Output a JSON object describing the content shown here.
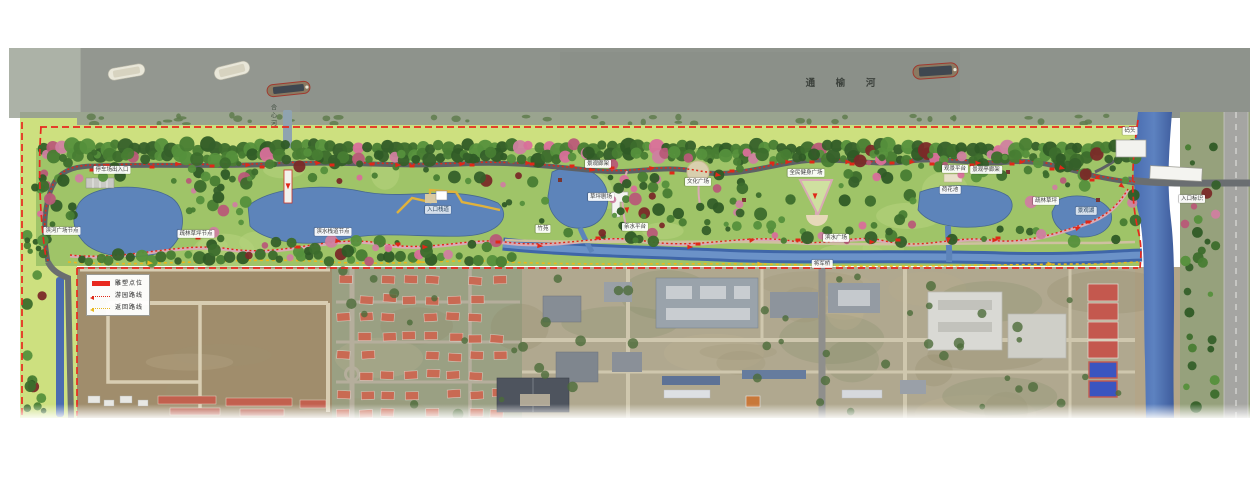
{
  "map": {
    "river_label": "通 榆 河",
    "legend": {
      "items": [
        {
          "symbol": "sculpture-marker",
          "label": "雕塑点位"
        },
        {
          "symbol": "tour-route",
          "label": "游园路线"
        },
        {
          "symbol": "return-route",
          "label": "返回路线"
        }
      ]
    },
    "colors": {
      "boundary": "#e8281e",
      "tour_route": "#e02818",
      "return_route": "#e8b820",
      "park_water": "#5d84ba",
      "big_river": "#8e938c",
      "canal": "#3f66a8"
    },
    "labels": [
      {
        "text": "停车场出入口",
        "x": 112,
        "y": 170
      },
      {
        "text": "滨河广场节点",
        "x": 62,
        "y": 231
      },
      {
        "text": "疏林草坪节点",
        "x": 196,
        "y": 234
      },
      {
        "text": "滨水栈道节点",
        "x": 333,
        "y": 232
      },
      {
        "text": "入口栈道",
        "x": 438,
        "y": 210,
        "variant": "dark"
      },
      {
        "text": "竹苑",
        "x": 543,
        "y": 229
      },
      {
        "text": "景观廊架",
        "x": 598,
        "y": 164
      },
      {
        "text": "草坪剧场",
        "x": 601,
        "y": 197
      },
      {
        "text": "亲水平台",
        "x": 635,
        "y": 227
      },
      {
        "text": "文化广场",
        "x": 698,
        "y": 182
      },
      {
        "text": "全民健身广场",
        "x": 806,
        "y": 173
      },
      {
        "text": "滨水广场",
        "x": 836,
        "y": 238
      },
      {
        "text": "荷花池",
        "x": 950,
        "y": 190
      },
      {
        "text": "观景平台",
        "x": 955,
        "y": 169
      },
      {
        "text": "景观亭廊架",
        "x": 986,
        "y": 170
      },
      {
        "text": "疏林草坪",
        "x": 1046,
        "y": 201
      },
      {
        "text": "景观湖",
        "x": 1086,
        "y": 211,
        "variant": "dark"
      },
      {
        "text": "码头",
        "x": 1130,
        "y": 131
      },
      {
        "text": "入口标识",
        "x": 1192,
        "y": 199
      },
      {
        "text": "将军桥",
        "x": 822,
        "y": 264
      },
      {
        "text": "合心河",
        "x": 272,
        "y": 116,
        "variant": "vertical"
      }
    ],
    "ships": [
      {
        "x": 108,
        "y": 66,
        "w": 37,
        "h": 12,
        "angle": -10,
        "variant": "light"
      },
      {
        "x": 214,
        "y": 64,
        "w": 36,
        "h": 13,
        "angle": -14,
        "variant": "light"
      },
      {
        "x": 267,
        "y": 83,
        "w": 43,
        "h": 12,
        "angle": -6,
        "variant": "dark"
      },
      {
        "x": 913,
        "y": 64,
        "w": 45,
        "h": 14,
        "angle": -4,
        "variant": "dark"
      }
    ],
    "route_arrows": {
      "red": [
        [
          108,
          166,
          5
        ],
        [
          178,
          164,
          0
        ],
        [
          248,
          165,
          0
        ],
        [
          288,
          186,
          90
        ],
        [
          318,
          163,
          0
        ],
        [
          398,
          165,
          0
        ],
        [
          462,
          164,
          0
        ],
        [
          528,
          163,
          0
        ],
        [
          592,
          170,
          10
        ],
        [
          627,
          210,
          85
        ],
        [
          652,
          168,
          -10
        ],
        [
          718,
          175,
          10
        ],
        [
          752,
          240,
          -10
        ],
        [
          788,
          162,
          0
        ],
        [
          815,
          196,
          90
        ],
        [
          848,
          162,
          0
        ],
        [
          872,
          242,
          0
        ],
        [
          912,
          162,
          0
        ],
        [
          948,
          240,
          95
        ],
        [
          978,
          163,
          0
        ],
        [
          1022,
          162,
          0
        ],
        [
          1062,
          168,
          15
        ],
        [
          1098,
          178,
          25
        ],
        [
          1122,
          186,
          35
        ],
        [
          338,
          241,
          5
        ],
        [
          425,
          247,
          0
        ],
        [
          540,
          246,
          5
        ],
        [
          690,
          247,
          0
        ],
        [
          995,
          240,
          0
        ],
        [
          1078,
          228,
          -20
        ]
      ],
      "yellow": [
        [
          150,
          263,
          5
        ],
        [
          420,
          262,
          0
        ],
        [
          760,
          264,
          0
        ],
        [
          1050,
          264,
          0
        ]
      ]
    },
    "sculpture_points": [
      [
        92,
        170
      ],
      [
        152,
        167
      ],
      [
        212,
        166
      ],
      [
        262,
        167
      ],
      [
        332,
        165
      ],
      [
        372,
        164
      ],
      [
        412,
        166
      ],
      [
        472,
        165
      ],
      [
        532,
        164
      ],
      [
        572,
        166
      ],
      [
        612,
        168
      ],
      [
        672,
        173
      ],
      [
        732,
        171
      ],
      [
        772,
        163
      ],
      [
        812,
        162
      ],
      [
        852,
        164
      ],
      [
        892,
        163
      ],
      [
        932,
        164
      ],
      [
        972,
        165
      ],
      [
        1012,
        164
      ],
      [
        1052,
        169
      ],
      [
        1092,
        180
      ],
      [
        198,
        238
      ],
      [
        298,
        247
      ],
      [
        398,
        244
      ],
      [
        498,
        242
      ],
      [
        598,
        238
      ],
      [
        698,
        244
      ],
      [
        798,
        240
      ],
      [
        898,
        240
      ],
      [
        998,
        238
      ],
      [
        1088,
        222
      ]
    ]
  }
}
